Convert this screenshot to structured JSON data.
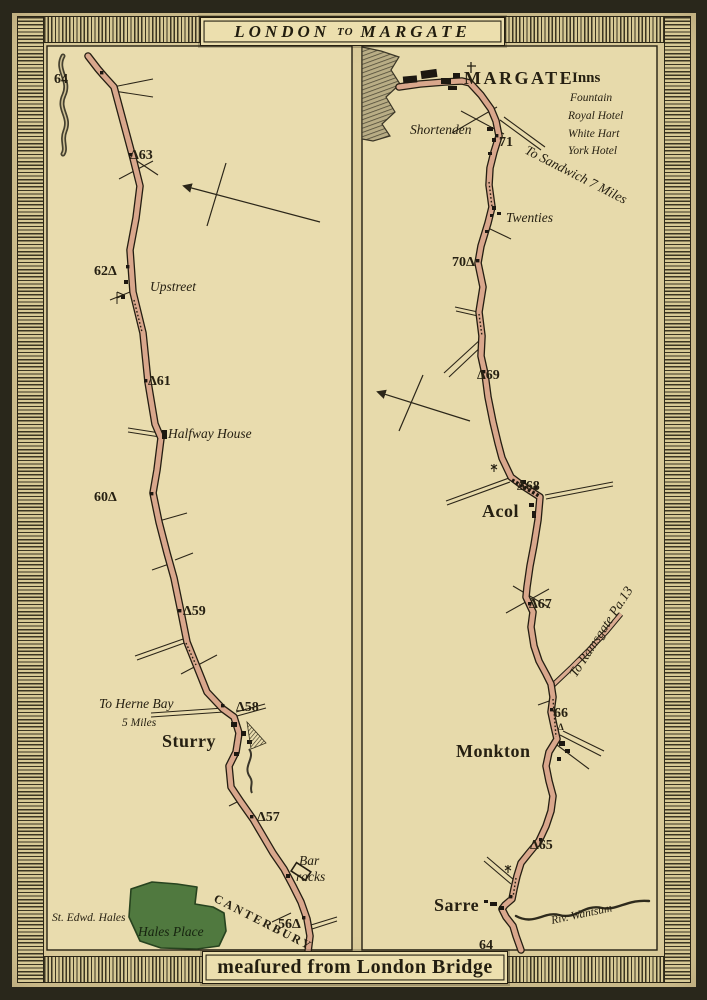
{
  "banner": {
    "title_part1": "LONDON",
    "title_part2": "TO",
    "title_part3": "MARGATE"
  },
  "footer": {
    "text": "meaſured from London Bridge"
  },
  "colors": {
    "paper": "#dccd9c",
    "panel": "#e9dcae",
    "road": "#d9a78c",
    "ink": "#262012",
    "green": "#50793f",
    "frame": "#29271b"
  },
  "left_panel": {
    "labels": {
      "m64": "64",
      "m63": "Δ63",
      "m62": "62Δ",
      "upstreet": "Upstreet",
      "m61": "Δ61",
      "halfway": "Halfway House",
      "m60": "60Δ",
      "m59": "Δ59",
      "herne_1": "To Herne Bay",
      "herne_2": "5 Miles",
      "m58": "Δ58",
      "sturry": "Sturry",
      "m57": "Δ57",
      "barracks_1": "Bar",
      "barracks_2": "racks",
      "st_edw": "St. Edwd. Hales",
      "hales_place": "Hales Place",
      "canterbury": "CANTERBURY",
      "m56": "56Δ"
    }
  },
  "right_panel": {
    "labels": {
      "margate": "MARGATE",
      "inns_title": "Inns",
      "inn_1": "Fountain",
      "inn_2": "Royal Hotel",
      "inn_3": "White Hart",
      "inn_4": "York Hotel",
      "shortenden": "Shortenden",
      "m71": "71",
      "sandwich": "To Sandwich 7 Miles",
      "twenties": "Twenties",
      "m70": "70Δ",
      "m69": "Δ69",
      "m68": "Δ68",
      "acol": "Acol",
      "m67": "Δ67",
      "ramsgate": "To Ramsgate Pa.13",
      "m66": "66",
      "m66_tri": "Δ",
      "monkton": "Monkton",
      "m65": "Δ65",
      "sarre": "Sarre",
      "wantsum": "Riv. Wantsum",
      "m64": "64"
    }
  }
}
